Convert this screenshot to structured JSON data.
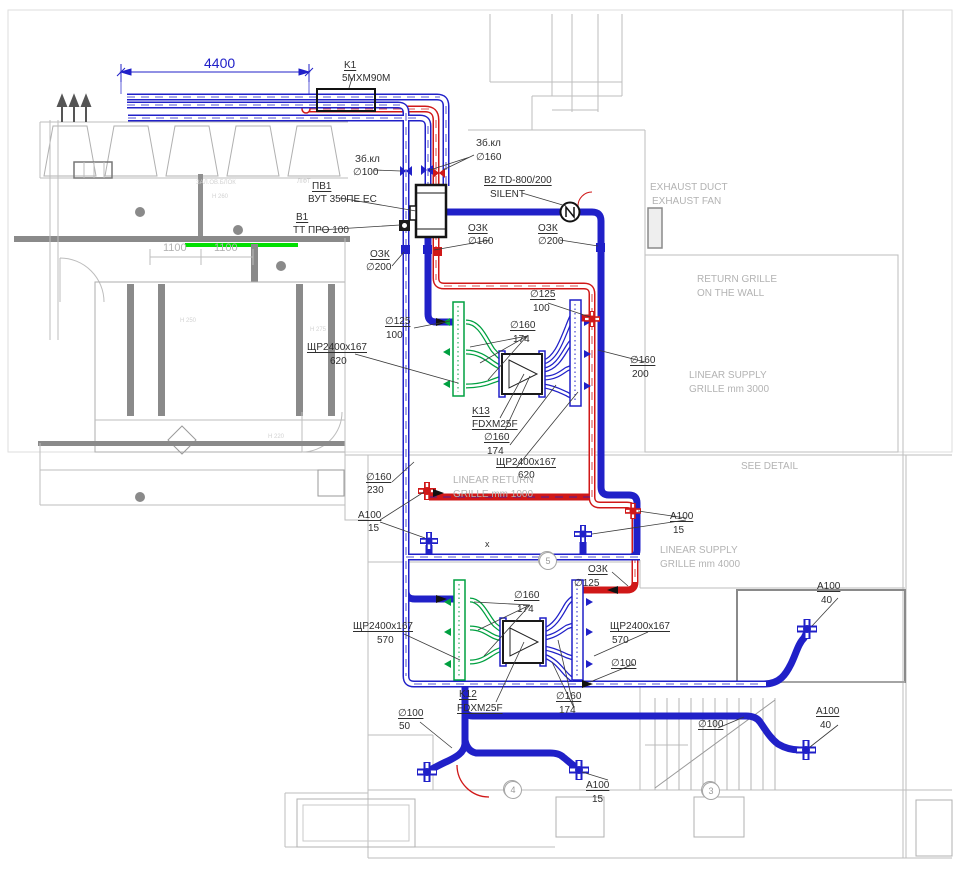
{
  "drawing": {
    "kind": "HVAC ventilation plan",
    "accent_colors": {
      "supply_red": "#d01818",
      "ducts_blue": "#2020c8",
      "grille_green": "#00a040",
      "highlight_green": "#00e000",
      "arch_gray": "#b3b3b3"
    }
  },
  "dimensions": {
    "top_span": "4400",
    "wall_left": "1100",
    "wall_right": "1100"
  },
  "grid_bubbles": [
    {
      "n": "5",
      "x": 539,
      "y": 552
    },
    {
      "n": "4",
      "x": 504,
      "y": 781
    },
    {
      "n": "3",
      "x": 702,
      "y": 782
    }
  ],
  "labels": [
    {
      "t": "4400",
      "x": 204,
      "y": 56,
      "c": "b",
      "fs": 14
    },
    {
      "t": "K1",
      "x": 344,
      "y": 61,
      "c": "d",
      "u": 1
    },
    {
      "t": "5MXM90M",
      "x": 342,
      "y": 74,
      "c": "d"
    },
    {
      "t": "Зб.кл",
      "x": 355,
      "y": 155,
      "c": "d"
    },
    {
      "t": "∅100",
      "x": 353,
      "y": 168,
      "c": "d"
    },
    {
      "t": "Зб.кл",
      "x": 476,
      "y": 139,
      "c": "d"
    },
    {
      "t": "∅160",
      "x": 476,
      "y": 153,
      "c": "d"
    },
    {
      "t": "ПВ1",
      "x": 312,
      "y": 182,
      "c": "d",
      "u": 1
    },
    {
      "t": "ВУТ 350ПЕ ЕС",
      "x": 308,
      "y": 195,
      "c": "d"
    },
    {
      "t": "В1",
      "x": 296,
      "y": 213,
      "c": "d",
      "u": 1
    },
    {
      "t": "ТТ ПРО 100",
      "x": 293,
      "y": 226,
      "c": "d"
    },
    {
      "t": "B2 TD-800/200",
      "x": 484,
      "y": 176,
      "c": "d",
      "u": 1
    },
    {
      "t": "SILENT",
      "x": 490,
      "y": 190,
      "c": "d"
    },
    {
      "t": "EXHAUST DUCT",
      "x": 650,
      "y": 183,
      "c": "g"
    },
    {
      "t": "EXHAUST FAN",
      "x": 652,
      "y": 197,
      "c": "g"
    },
    {
      "t": "ОЗК",
      "x": 468,
      "y": 224,
      "c": "d",
      "u": 1
    },
    {
      "t": "∅160",
      "x": 468,
      "y": 237,
      "c": "d"
    },
    {
      "t": "ОЗК",
      "x": 538,
      "y": 224,
      "c": "d",
      "u": 1
    },
    {
      "t": "∅200",
      "x": 538,
      "y": 237,
      "c": "d"
    },
    {
      "t": "ОЗК",
      "x": 370,
      "y": 250,
      "c": "d",
      "u": 1
    },
    {
      "t": "∅200",
      "x": 366,
      "y": 263,
      "c": "d"
    },
    {
      "t": "RETURN GRILLE",
      "x": 697,
      "y": 275,
      "c": "g"
    },
    {
      "t": "ON THE WALL",
      "x": 697,
      "y": 289,
      "c": "g"
    },
    {
      "t": "∅125",
      "x": 530,
      "y": 290,
      "c": "d",
      "u": 1
    },
    {
      "t": "100",
      "x": 533,
      "y": 304,
      "c": "d"
    },
    {
      "t": "∅125",
      "x": 385,
      "y": 317,
      "c": "d",
      "u": 1
    },
    {
      "t": "100",
      "x": 386,
      "y": 331,
      "c": "d"
    },
    {
      "t": "∅160",
      "x": 510,
      "y": 321,
      "c": "d",
      "u": 1
    },
    {
      "t": "174",
      "x": 513,
      "y": 335,
      "c": "d"
    },
    {
      "t": "ЩР2400х167",
      "x": 307,
      "y": 343,
      "c": "d",
      "u": 1
    },
    {
      "t": "620",
      "x": 330,
      "y": 357,
      "c": "d"
    },
    {
      "t": "∅160",
      "x": 630,
      "y": 356,
      "c": "d",
      "u": 1
    },
    {
      "t": "200",
      "x": 632,
      "y": 370,
      "c": "d"
    },
    {
      "t": "LINEAR SUPPLY",
      "x": 689,
      "y": 371,
      "c": "g"
    },
    {
      "t": "GRILLE mm 3000",
      "x": 689,
      "y": 385,
      "c": "g"
    },
    {
      "t": "K13",
      "x": 472,
      "y": 407,
      "c": "d",
      "u": 1
    },
    {
      "t": "FDXM25F",
      "x": 472,
      "y": 420,
      "c": "d",
      "u": 1
    },
    {
      "t": "∅160",
      "x": 484,
      "y": 433,
      "c": "d",
      "u": 1
    },
    {
      "t": "174",
      "x": 487,
      "y": 447,
      "c": "d"
    },
    {
      "t": "ЩР2400х167",
      "x": 496,
      "y": 458,
      "c": "d",
      "u": 1
    },
    {
      "t": "620",
      "x": 518,
      "y": 471,
      "c": "d"
    },
    {
      "t": "SEE DETAIL",
      "x": 741,
      "y": 462,
      "c": "g"
    },
    {
      "t": "∅160",
      "x": 366,
      "y": 473,
      "c": "d",
      "u": 1
    },
    {
      "t": "230",
      "x": 367,
      "y": 486,
      "c": "d"
    },
    {
      "t": "LINEAR RETURN",
      "x": 453,
      "y": 476,
      "c": "g"
    },
    {
      "t": "GRILLE mm 1000",
      "x": 453,
      "y": 490,
      "c": "g"
    },
    {
      "t": "А100",
      "x": 358,
      "y": 511,
      "c": "d",
      "u": 1
    },
    {
      "t": "15",
      "x": 368,
      "y": 524,
      "c": "d"
    },
    {
      "t": "А100",
      "x": 670,
      "y": 512,
      "c": "d",
      "u": 1
    },
    {
      "t": "15",
      "x": 673,
      "y": 526,
      "c": "d"
    },
    {
      "t": "LINEAR SUPPLY",
      "x": 660,
      "y": 546,
      "c": "g"
    },
    {
      "t": "GRILLE mm 4000",
      "x": 660,
      "y": 560,
      "c": "g"
    },
    {
      "t": "x",
      "x": 485,
      "y": 540,
      "c": "d",
      "fs": 9
    },
    {
      "t": "ОЗК",
      "x": 588,
      "y": 565,
      "c": "d",
      "u": 1
    },
    {
      "t": "∅125",
      "x": 574,
      "y": 579,
      "c": "d"
    },
    {
      "t": "∅160",
      "x": 514,
      "y": 591,
      "c": "d",
      "u": 1
    },
    {
      "t": "174",
      "x": 517,
      "y": 605,
      "c": "d"
    },
    {
      "t": "ЩР2400х167",
      "x": 353,
      "y": 622,
      "c": "d",
      "u": 1
    },
    {
      "t": "570",
      "x": 377,
      "y": 636,
      "c": "d"
    },
    {
      "t": "ЩР2400х167",
      "x": 610,
      "y": 622,
      "c": "d",
      "u": 1
    },
    {
      "t": "570",
      "x": 612,
      "y": 636,
      "c": "d"
    },
    {
      "t": "А100",
      "x": 817,
      "y": 582,
      "c": "d",
      "u": 1
    },
    {
      "t": "40",
      "x": 821,
      "y": 596,
      "c": "d"
    },
    {
      "t": "∅100",
      "x": 611,
      "y": 659,
      "c": "d",
      "u": 1
    },
    {
      "t": "K12",
      "x": 459,
      "y": 690,
      "c": "d",
      "u": 1
    },
    {
      "t": "FDXM25F",
      "x": 457,
      "y": 704,
      "c": "d",
      "u": 1
    },
    {
      "t": "∅160",
      "x": 556,
      "y": 692,
      "c": "d",
      "u": 1
    },
    {
      "t": "174",
      "x": 559,
      "y": 706,
      "c": "d"
    },
    {
      "t": "∅100",
      "x": 398,
      "y": 709,
      "c": "d",
      "u": 1
    },
    {
      "t": "50",
      "x": 399,
      "y": 722,
      "c": "d"
    },
    {
      "t": "∅100",
      "x": 698,
      "y": 720,
      "c": "d",
      "u": 1
    },
    {
      "t": "А100",
      "x": 816,
      "y": 707,
      "c": "d",
      "u": 1
    },
    {
      "t": "40",
      "x": 820,
      "y": 721,
      "c": "d"
    },
    {
      "t": "А100",
      "x": 586,
      "y": 781,
      "c": "d",
      "u": 1
    },
    {
      "t": "15",
      "x": 592,
      "y": 795,
      "c": "d"
    },
    {
      "t": "1100",
      "x": 163,
      "y": 243,
      "c": "g",
      "fs": 11
    },
    {
      "t": "1100",
      "x": 214,
      "y": 243,
      "c": "g",
      "fs": 11
    },
    {
      "t": "ЗАЛ.ОВ.БЛОК",
      "x": 196,
      "y": 180,
      "c": "f",
      "fs": 6
    },
    {
      "t": "ЛІФТ",
      "x": 297,
      "y": 179,
      "c": "f",
      "fs": 6
    },
    {
      "t": "Н 260",
      "x": 212,
      "y": 194,
      "c": "f",
      "fs": 6
    },
    {
      "t": "Н 250",
      "x": 180,
      "y": 318,
      "c": "f",
      "fs": 6
    },
    {
      "t": "Н 275",
      "x": 310,
      "y": 327,
      "c": "f",
      "fs": 6
    },
    {
      "t": "Н 220",
      "x": 268,
      "y": 434,
      "c": "f",
      "fs": 6
    }
  ]
}
